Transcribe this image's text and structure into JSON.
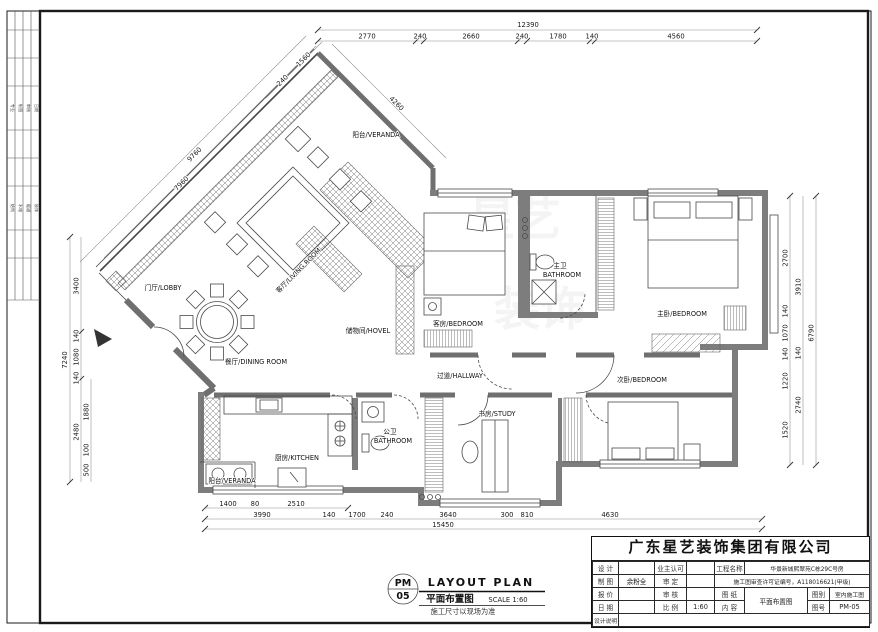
{
  "sheet": {
    "stamp": {
      "code_top": "PM",
      "code_bottom": "05",
      "title_en": "LAYOUT  PLAN",
      "title_cn": "平面布置图",
      "scale": "SCALE 1:60",
      "note": "施工尺寸以现场为准"
    },
    "watermark": {
      "part1": "星艺",
      "part2": "装饰"
    }
  },
  "side_strip": {
    "group1": [
      "专业",
      "制图",
      "审核",
      "日期"
    ],
    "group2": [
      "结构",
      "水电",
      "暖通",
      "装饰"
    ]
  },
  "rooms": {
    "veranda_top": "阳台/VERANDA",
    "living": "客厅/LIVING ROOM",
    "lobby": "门厅/LOBBY",
    "dining": "餐厅/DINING ROOM",
    "hovel": "储物间/HOVEL",
    "guest_bedroom": "客房/BEDROOM",
    "master_bath_cn": "主卫",
    "master_bath_en": "BATHROOM",
    "master_bedroom": "主卧/BEDROOM",
    "second_bedroom": "次卧/BEDROOM",
    "hallway": "过道/HALLWAY",
    "study": "书房/STUDY",
    "public_bath_cn": "公卫",
    "public_bath_en": "BATHROOM",
    "kitchen": "厨房/KITCHEN",
    "veranda_bottom": "阳台/VERANDA"
  },
  "dims": {
    "top_total": "12390",
    "top": [
      "2770",
      "240",
      "2660",
      "240",
      "1780",
      "140",
      "4560"
    ],
    "left_outer": "7240",
    "left_mid": [
      "3400",
      "140",
      "1080",
      "140",
      "2480"
    ],
    "left_inner": [
      "1880",
      "100",
      "500"
    ],
    "right_inner": [
      "2700",
      "140",
      "1070",
      "140",
      "1220",
      "1520"
    ],
    "right_mid": [
      "3910",
      "140",
      "2740"
    ],
    "right_total": "6790",
    "bottom_first": [
      "1400",
      "80",
      "2510"
    ],
    "bottom_mid": [
      "3990",
      "140",
      "1700",
      "240",
      "3640",
      "300",
      "810",
      "4630"
    ],
    "bottom_total": "15450",
    "diag_upper_left": [
      "9760",
      "7960"
    ],
    "diag_small": [
      "240",
      "1560"
    ],
    "diag_right": "4260"
  },
  "titleblock": {
    "company": "广东星艺装饰集团有限公司",
    "design_label": "设 计",
    "owner_label": "业主认可",
    "project_label": "工程名称",
    "project_value": "华景新城熙翠苑C栋29C号房",
    "draft_label": "制 图",
    "draft_value": "余粉全",
    "approve_label": "审 定",
    "permit_value": "施工图审查许可证编号，A118016621(甲级)",
    "quote_label": "报 价",
    "review_label": "审 核",
    "sheet_label": "图 纸",
    "content_label": "内 容",
    "sheet_value": "平面布置图",
    "cat_label": "图别",
    "cat_value": "室内施工图",
    "date_label": "日 期",
    "scale_label": "比 例",
    "scale_value": "1:60",
    "no_label": "图号",
    "no_value": "PM-05",
    "note_label": "设计说明"
  }
}
